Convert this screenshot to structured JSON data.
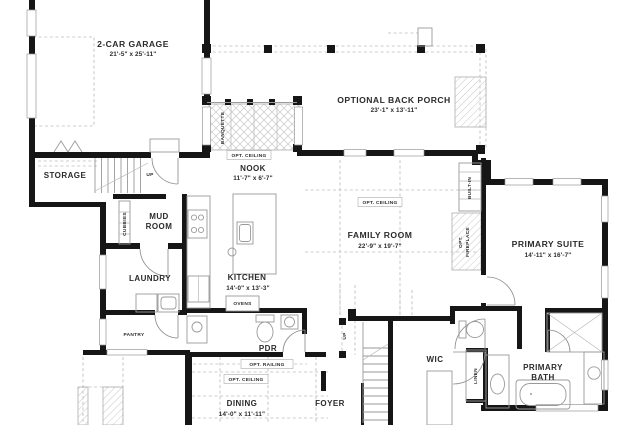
{
  "rooms": {
    "garage": {
      "name": "2-CAR GARAGE",
      "dims": "21'-5\" x 25'-11\""
    },
    "porch": {
      "name": "OPTIONAL BACK PORCH",
      "dims": "23'-1\" x 13'-11\""
    },
    "storage": {
      "name": "STORAGE"
    },
    "nook": {
      "name": "NOOK",
      "dims": "11'-7\" x 6'-7\""
    },
    "mud_room": {
      "line1": "MUD",
      "line2": "ROOM"
    },
    "family_room": {
      "name": "FAMILY ROOM",
      "dims": "22'-9\" x 19'-7\""
    },
    "primary_suite": {
      "name": "PRIMARY SUITE",
      "dims": "14'-11\" x 16'-7\""
    },
    "laundry": {
      "name": "LAUNDRY"
    },
    "kitchen": {
      "name": "KITCHEN",
      "dims": "14'-0\" x 13'-3\""
    },
    "pdr": {
      "name": "PDR"
    },
    "pantry": {
      "name": "PANTRY"
    },
    "wic": {
      "name": "WIC"
    },
    "primary_bath": {
      "line1": "PRIMARY",
      "line2": "BATH"
    },
    "dining": {
      "name": "DINING",
      "dims": "14'-0\" x 11'-11\""
    },
    "foyer": {
      "name": "FOYER"
    }
  },
  "annotations": {
    "opt_ceiling": "OPT. CEILING",
    "opt_railing": "OPT. RAILING",
    "banquette": "BANQUETTE",
    "cubbies": "CUBBIES",
    "built_in": "BUILT-IN",
    "opt_fireplace_line1": "OPT.",
    "opt_fireplace_line2": "FIREPLACE",
    "ovens": "OVENS",
    "linen": "LINEN",
    "up": "UP"
  },
  "colors": {
    "wall": "#161616",
    "thin_line": "#9a9a9a",
    "dashed_line": "#bcbcbc",
    "text": "#2b2b2b",
    "background": "#ffffff"
  }
}
